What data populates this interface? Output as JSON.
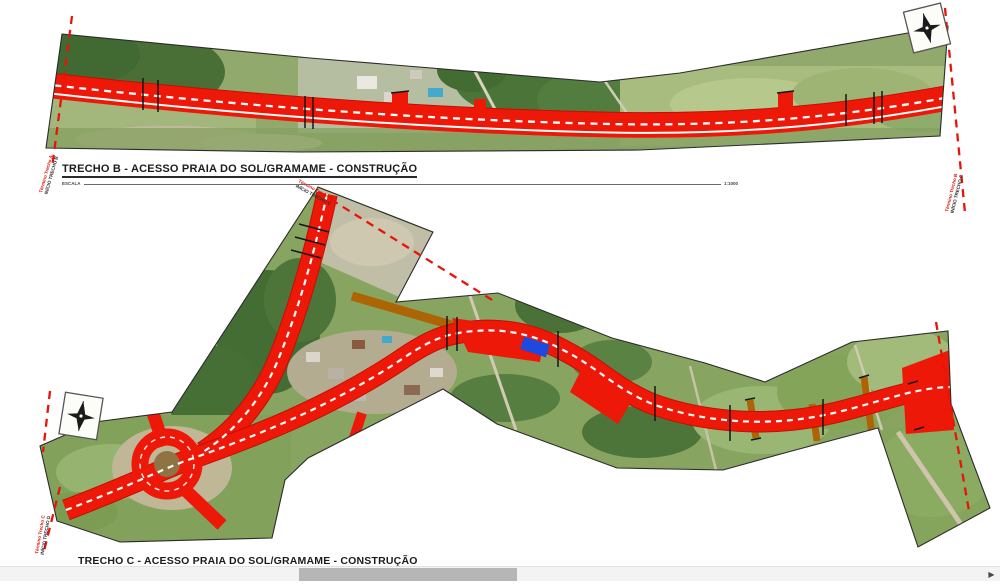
{
  "trecho_b": {
    "title": "TRECHO B - ACESSO PRAIA DO SOL/GRAMAME - CONSTRUÇÃO",
    "scale_label": "ESCALA",
    "scale_value": "1:1000",
    "marker_start_line1": "Término Trecho A",
    "marker_start_line2": "INÍCIO TRECHO B",
    "marker_end_line1": "Término Trecho B",
    "marker_end_line2": "INÍCIO TRECHO C"
  },
  "trecho_c": {
    "title": "TRECHO C - ACESSO PRAIA DO SOL/GRAMAME - CONSTRUÇÃO",
    "marker_start_line1": "Término Trecho B",
    "marker_start_line2": "INÍCIO TRECHO C",
    "marker_end_line1": "Término Trecho C",
    "marker_end_line2": "INÍCIO TRECHO D"
  },
  "map_legend": {
    "construction_road_color": "#ee1808",
    "existing_road_color": "#ad6405",
    "bridge_color": "#1c49df",
    "station_line_color": "#e8140a"
  },
  "icons": {
    "north_arrow": "north-arrow-compass",
    "scroll_right_arrow": "▶"
  }
}
